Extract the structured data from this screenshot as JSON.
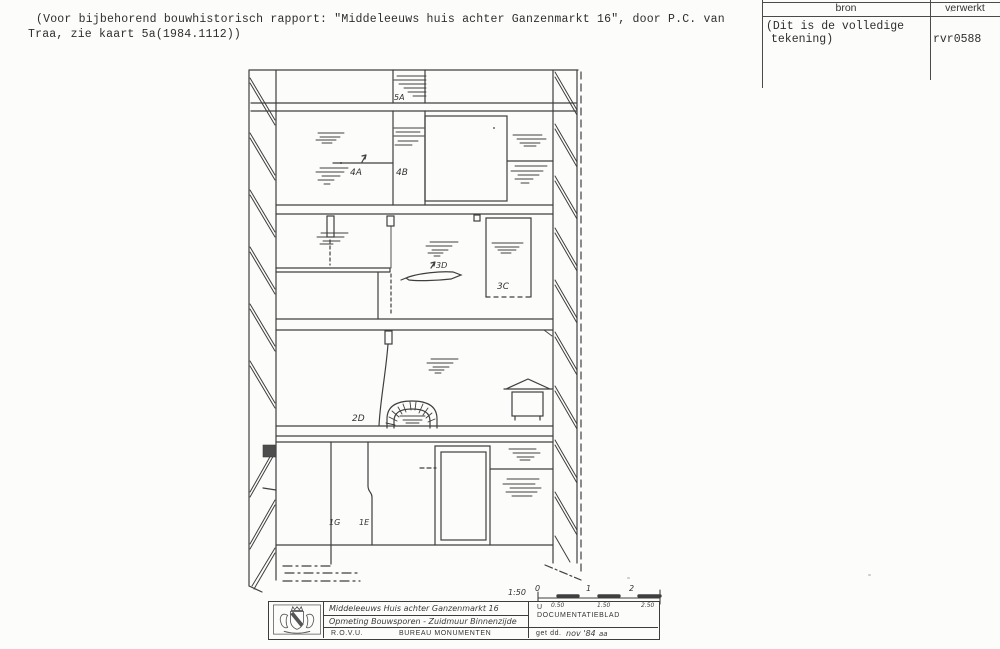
{
  "note": {
    "line1": "(Voor bijbehorend bouwhistorisch rapport: \"Middeleeuws huis achter Ganzenmarkt 16\", door P.C. van",
    "line2": "Traa, zie kaart 5a(1984.1112))"
  },
  "source_table": {
    "header_bron": "bron",
    "header_verwerkt": "verwerkt",
    "bron_line1": "(Dit is de volledige",
    "bron_line2": "tekening)",
    "verwerkt_value": "rvr0588"
  },
  "drawing": {
    "label_5a": "5A",
    "label_4a": "4A",
    "label_4b": "4B",
    "label_3d": "3D",
    "label_3c": "3C",
    "label_2d": "2D",
    "label_1g": "1G",
    "label_1e": "1E",
    "scale_ratio": "1:50",
    "scale_0": "0",
    "scale_1": "1",
    "scale_2": "2",
    "scale_sub1": "0.50",
    "scale_sub2": "1.50",
    "scale_sub3": "2.50"
  },
  "title_block": {
    "line1": "Middeleeuws Huis achter Ganzenmarkt 16",
    "line2": "Opmeting Bouwsporen - Zuidmuur Binnenzijde",
    "org": "R.O.V.U.",
    "bureau": "BUREAU MONUMENTEN",
    "u": "U",
    "doc": "DOCUMENTATIEBLAD",
    "date_label": "get dd.",
    "date_value": "nov '84",
    "initials": "aa"
  },
  "colors": {
    "ink": "#3f3f3f",
    "paper": "#fcfcfa"
  }
}
